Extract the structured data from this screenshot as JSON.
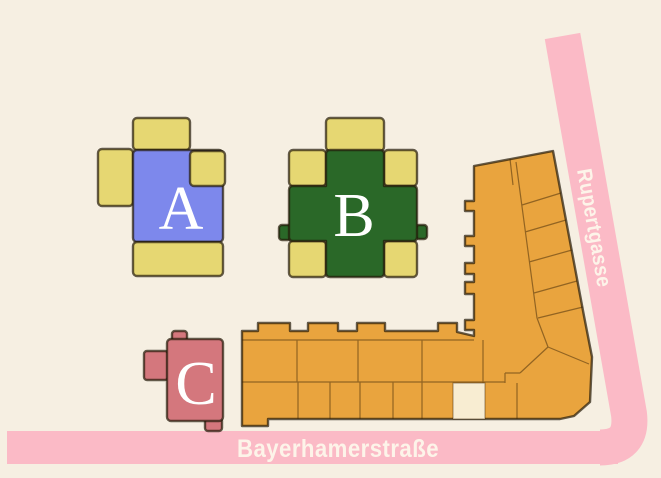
{
  "page": {
    "type": "site-plan"
  },
  "buildings": {
    "a": {
      "label": "A"
    },
    "b": {
      "label": "B"
    },
    "c": {
      "label": "C"
    }
  },
  "streets": {
    "vertical": {
      "name": "Rupertgasse"
    },
    "horizontal": {
      "name": "Bayerhamerstraße"
    }
  },
  "colors": {
    "background": "#f6efe2",
    "building_a_fill": "#7d88ec",
    "building_b_fill": "#2a6828",
    "building_c_fill": "#d4777d",
    "wing_yellow": "#e6d772",
    "complex_orange": "#e9a43e",
    "beige_unit": "#f8edd2",
    "street_pink": "#fbbac6",
    "street_text": "#fdf4e9",
    "label_text": "#ffffff"
  }
}
